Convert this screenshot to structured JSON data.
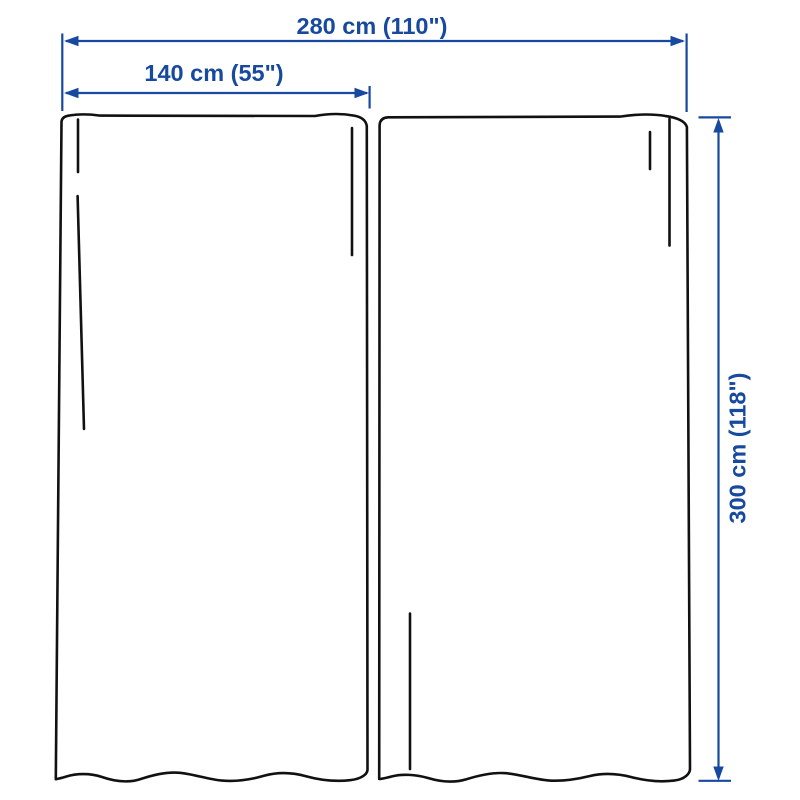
{
  "figure": {
    "subject": "curtain-pair-dimension-diagram",
    "panel_count": 2
  },
  "colors": {
    "outline": "#111111",
    "dimension": "#17499E",
    "background": "#ffffff"
  },
  "dimensions": {
    "total_width": {
      "label": "280 cm (110\")",
      "cm": 280,
      "inches": 110,
      "orientation": "horizontal"
    },
    "single_panel_width": {
      "label": "140 cm (55\")",
      "cm": 140,
      "inches": 55,
      "orientation": "horizontal"
    },
    "height": {
      "label": "300 cm (118\")",
      "cm": 300,
      "inches": 118,
      "orientation": "vertical"
    }
  }
}
